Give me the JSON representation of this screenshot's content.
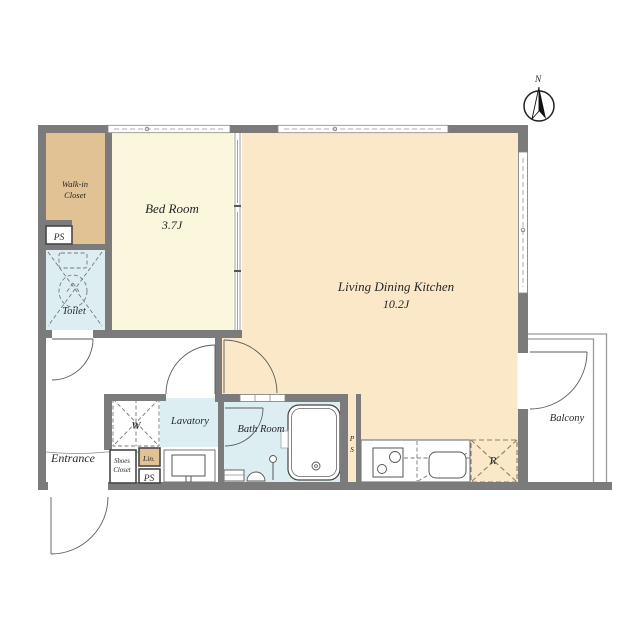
{
  "colors": {
    "wall": "#7b7b7b",
    "bedroom": "#faf7dd",
    "ldk": "#fae8c8",
    "tan": "#e1c294",
    "blue": "#ddeef3",
    "line": "#555555"
  },
  "compass": {
    "north_label": "N"
  },
  "rooms": {
    "walk_in_closet": {
      "line1": "Walk-in",
      "line2": "Closet"
    },
    "bedroom": {
      "name": "Bed Room",
      "size": "3.7J"
    },
    "ldk": {
      "name": "Living Dining Kitchen",
      "size": "10.2J"
    },
    "toilet": {
      "label": "Toilet"
    },
    "entrance": {
      "label": "Entrance"
    },
    "lavatory": {
      "label": "Lavatory"
    },
    "bathroom": {
      "label": "Bath Room"
    },
    "balcony": {
      "label": "Balcony"
    }
  },
  "fixtures": {
    "washer_pan": "W",
    "refrigerator": "R",
    "shoes_closet": {
      "line1": "Shoes",
      "line2": "Closet"
    },
    "linen": "Lin.",
    "pipe_space_upper": "PS",
    "pipe_space_lower": "PS",
    "pipe_space_shaft": {
      "line1": "P",
      "line2": "S"
    }
  }
}
